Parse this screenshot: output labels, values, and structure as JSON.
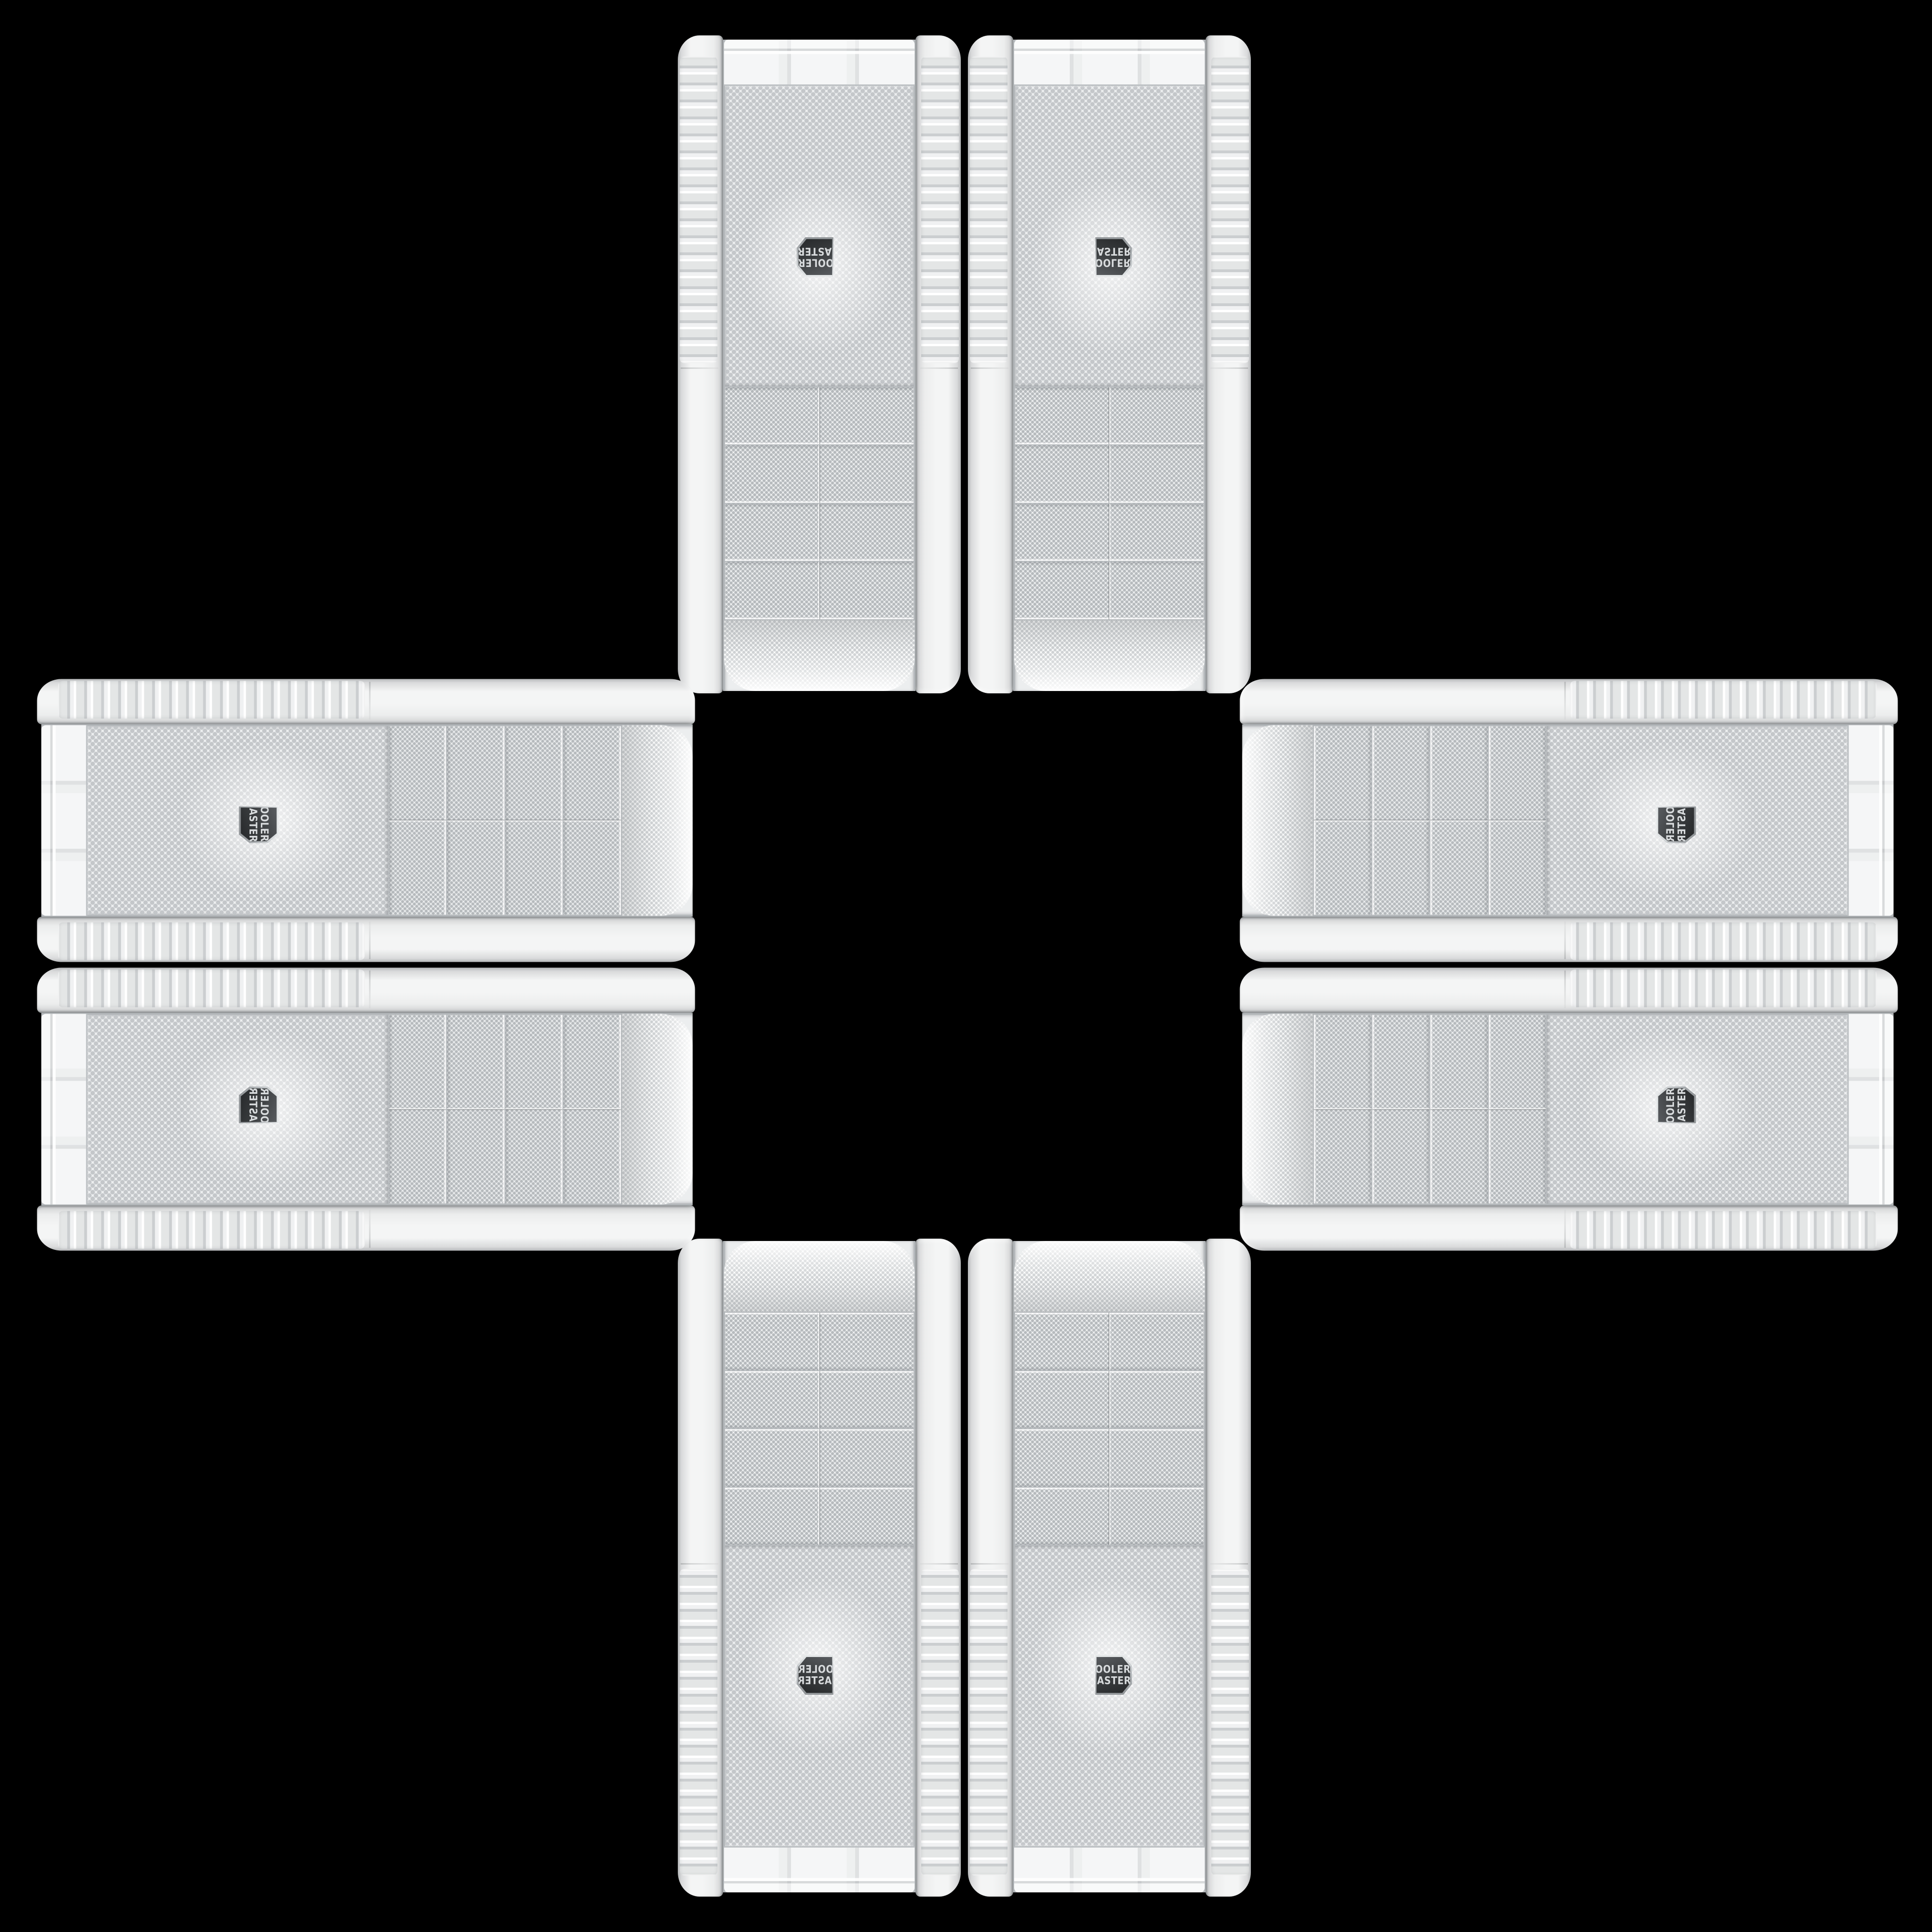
{
  "scene": {
    "background_color": "#000000",
    "layout": "cross-of-eight-cases",
    "center_empty": true
  },
  "brand_badge": {
    "line1": "COOLER",
    "line2": "MASTER",
    "badge_bg": "#3a3d3f",
    "badge_text_color": "#d8dbdd",
    "badge_trim_color": "#c3c7ca"
  },
  "palette": {
    "background": "#000000",
    "case_white": "#f4f5f5",
    "rail_shadow": "#b4b6b8",
    "mesh_base": "#eef0f1",
    "mesh_dot": "#c0c4c7",
    "chrome_trim": "#a7abae"
  },
  "cases": [
    {
      "id": "tower-top-left",
      "orientation": "vertical-rotated-180"
    },
    {
      "id": "tower-top-right",
      "orientation": "vertical-flipped-mirrored"
    },
    {
      "id": "tower-left-upper",
      "orientation": "horizontal-rotated-90"
    },
    {
      "id": "tower-right-upper",
      "orientation": "horizontal-rotated-90-mirrored"
    },
    {
      "id": "tower-left-lower",
      "orientation": "horizontal-rotated-90-flipped"
    },
    {
      "id": "tower-right-lower",
      "orientation": "horizontal-rotated-270"
    },
    {
      "id": "tower-bottom-left",
      "orientation": "vertical-mirrored"
    },
    {
      "id": "tower-bottom-right",
      "orientation": "vertical-upright"
    }
  ]
}
